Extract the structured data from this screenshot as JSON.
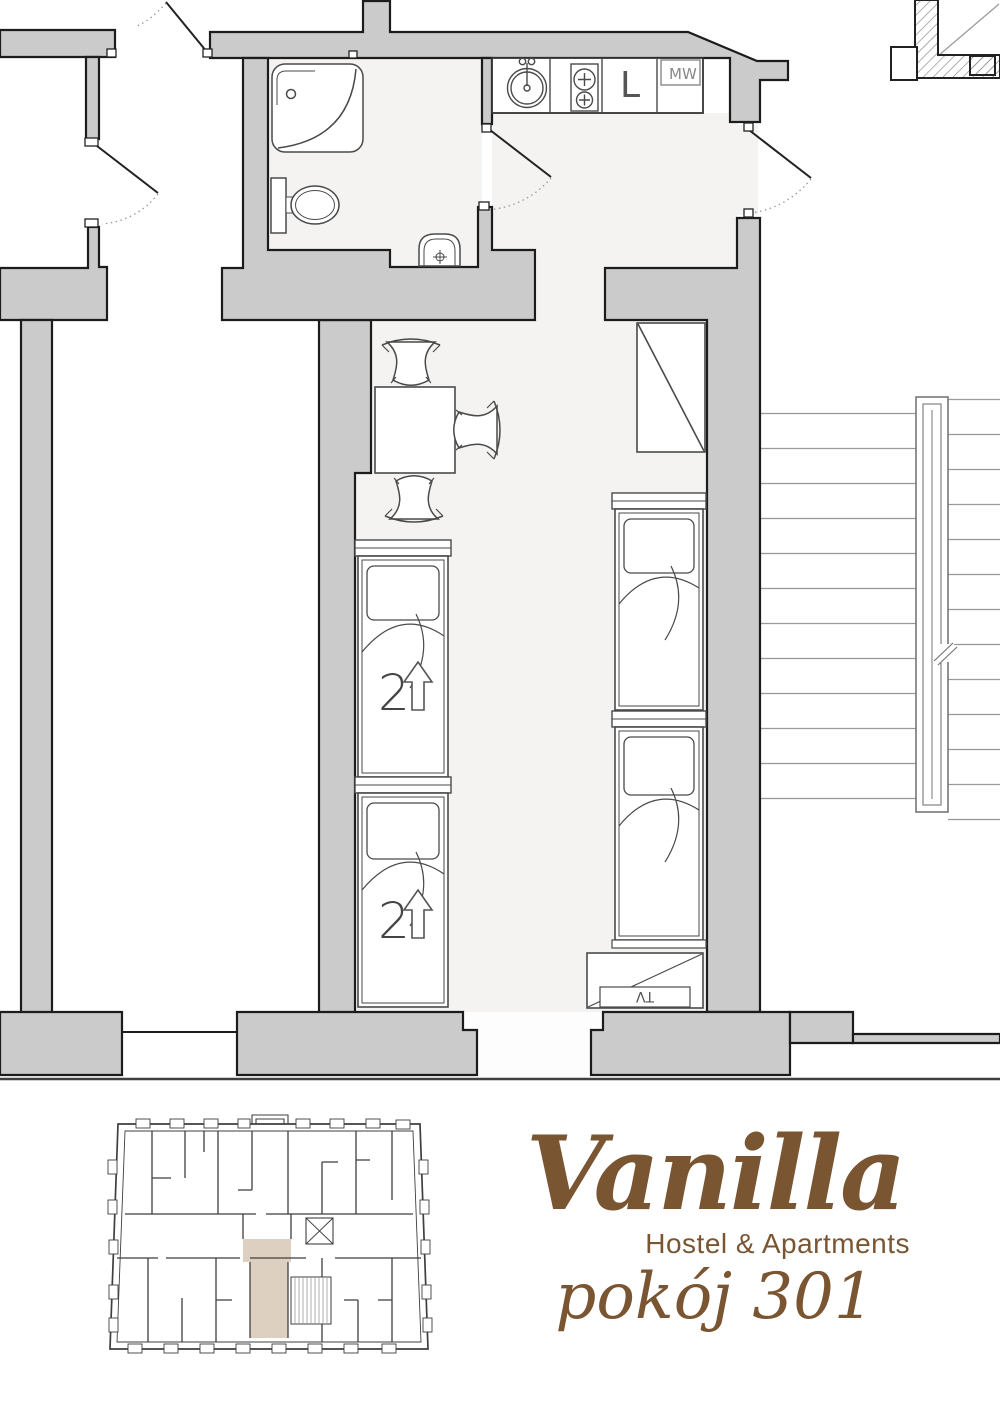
{
  "page": {
    "width": 1000,
    "height": 1414,
    "kind": "hostel room floor plan"
  },
  "branding": {
    "name": "Vanilla",
    "subtitle": "Hostel & Apartments",
    "room_label": "pokój 301",
    "brand_color": "#7a5531"
  },
  "plan_labels": {
    "microwave": "MW",
    "fridge": "L",
    "tv": "TV",
    "bunk_bed_1_capacity": "2",
    "bunk_bed_2_capacity": "2"
  },
  "rooms": [
    {
      "name": "bathroom",
      "fixtures": [
        "shower",
        "toilet",
        "washbasin"
      ]
    },
    {
      "name": "kitchenette",
      "fixtures": [
        "round sink",
        "two-burner stove",
        "fridge (L)",
        "microwave (MW)"
      ]
    },
    {
      "name": "bedroom",
      "furniture": [
        "table",
        "chair",
        "chair",
        "chair",
        "wardrobe",
        "bunk bed 2↑",
        "bunk bed 2↑",
        "single bed",
        "single bed",
        "TV stand"
      ]
    },
    {
      "name": "staircase",
      "features": [
        "two flights",
        "central handrail"
      ]
    }
  ],
  "minimap": {
    "description": "building floor overview plan",
    "highlighted_room": "301",
    "highlight_color": "#ddd0c1"
  },
  "colors": {
    "wall_fill": "#cbcbcb",
    "wall_outline": "#1c1c1c",
    "floor": "#f4f3f1",
    "furniture_line": "#4a4a4a",
    "stairs_line": "#9a9a9a",
    "brand_brown": "#7a5531"
  }
}
